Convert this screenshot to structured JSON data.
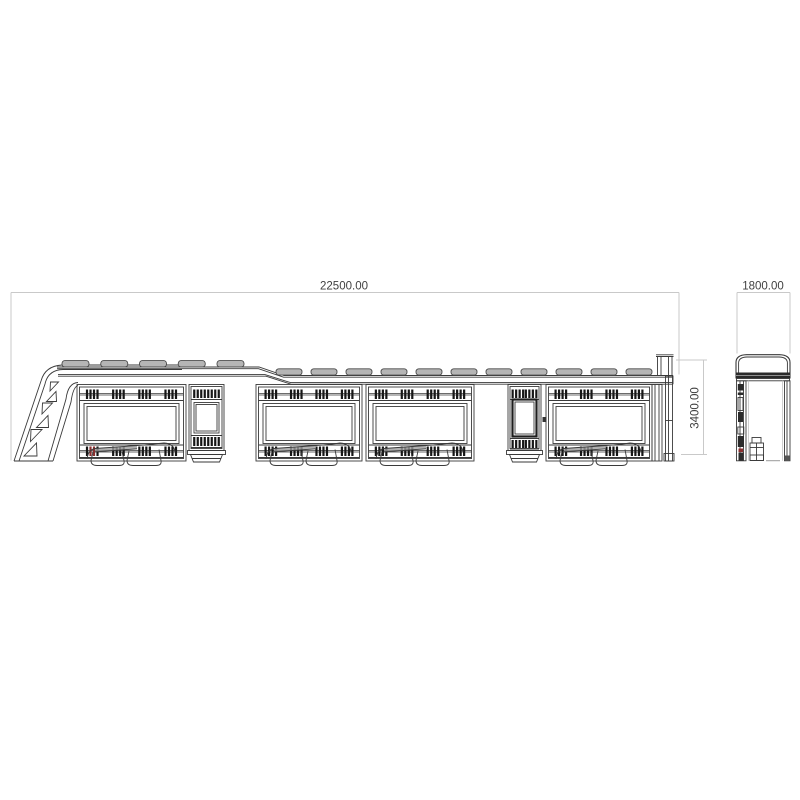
{
  "drawing": {
    "background": "#ffffff",
    "dimensions": {
      "length": {
        "label": "22500.00"
      },
      "width": {
        "label": "1800.00"
      },
      "height": {
        "label": "3400.00"
      }
    },
    "colors": {
      "line": "#3a3a3a",
      "line_faint": "#bbbbbb",
      "dim_line": "#c9c9c9",
      "text": "#3f3f3f",
      "pad_fill": "#b5b5b5",
      "pad_stroke": "#4a4a4a",
      "vent_bar": "#161616",
      "vent_accent": "#8a2e2e",
      "seat_fill": "#9c9c9c",
      "dark_fill": "#2b2b2b"
    }
  }
}
